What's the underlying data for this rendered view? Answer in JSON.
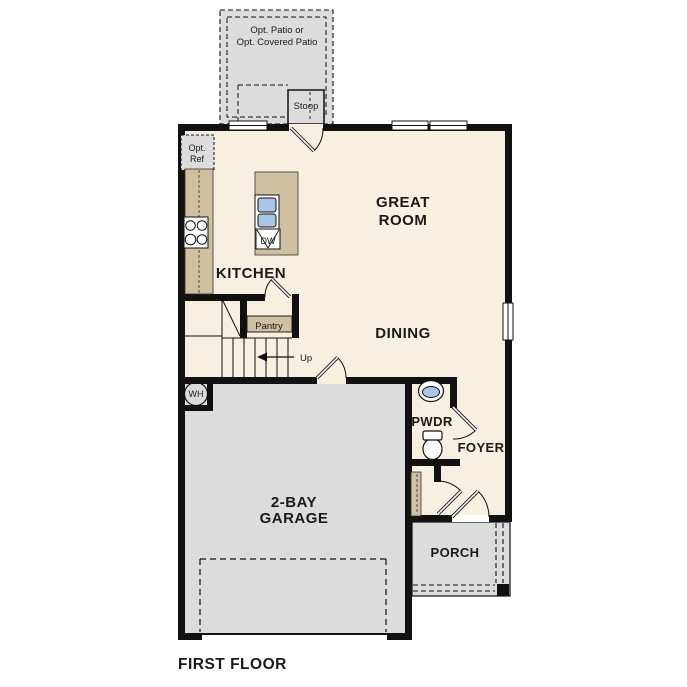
{
  "plan": {
    "title": "FIRST FLOOR",
    "rooms": {
      "great_room_line1": "GREAT",
      "great_room_line2": "ROOM",
      "kitchen": "KITCHEN",
      "dining": "DINING",
      "garage_line1": "2-BAY",
      "garage_line2": "GARAGE",
      "pwdr": "PWDR",
      "foyer": "FOYER",
      "porch": "PORCH"
    },
    "features": {
      "patio_line1": "Opt. Patio or",
      "patio_line2": "Opt. Covered Patio",
      "stoop": "Stoop",
      "ref_line1": "Opt.",
      "ref_line2": "Ref",
      "pantry": "Pantry",
      "up": "Up",
      "wh": "WH",
      "dw": "DW"
    },
    "colors": {
      "floor": "#f7efe0",
      "concrete": "#dcdcdc",
      "cabinet": "#cfc0a1",
      "fixture": "#a9c7e5",
      "wall": "#111111"
    }
  }
}
